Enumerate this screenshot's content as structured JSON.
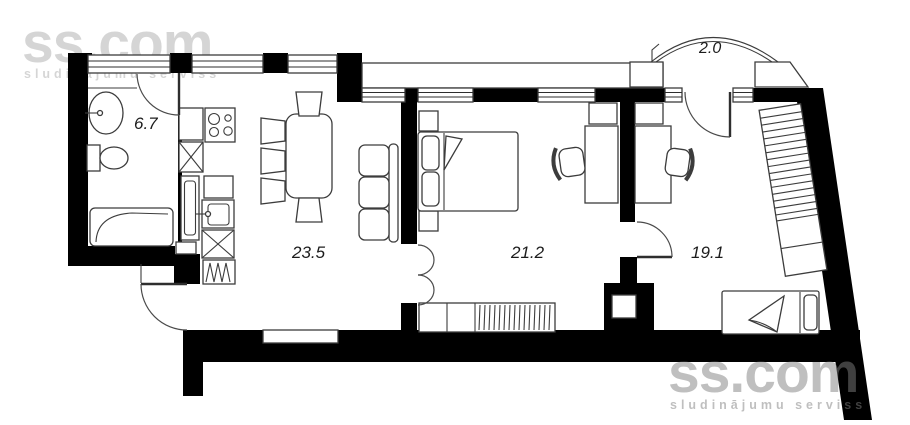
{
  "plan": {
    "rooms": [
      {
        "name": "bathroom",
        "area": "6.7"
      },
      {
        "name": "living-room-kitchen",
        "area": "23.5"
      },
      {
        "name": "bedroom",
        "area": "21.2"
      },
      {
        "name": "second-room",
        "area": "19.1"
      },
      {
        "name": "balcony",
        "area": "2.0"
      }
    ],
    "colors": {
      "wall": "#000000",
      "outline": "#3c3c3c",
      "background": "#ffffff",
      "label": "#1c1c1c",
      "watermark": "#808080"
    }
  },
  "watermark_top_left": {
    "brand": "ss.com",
    "tagline": "sludinājumu serviss"
  },
  "watermark_bottom_right": {
    "brand": "ss.com",
    "tagline": "sludinājumu serviss"
  }
}
